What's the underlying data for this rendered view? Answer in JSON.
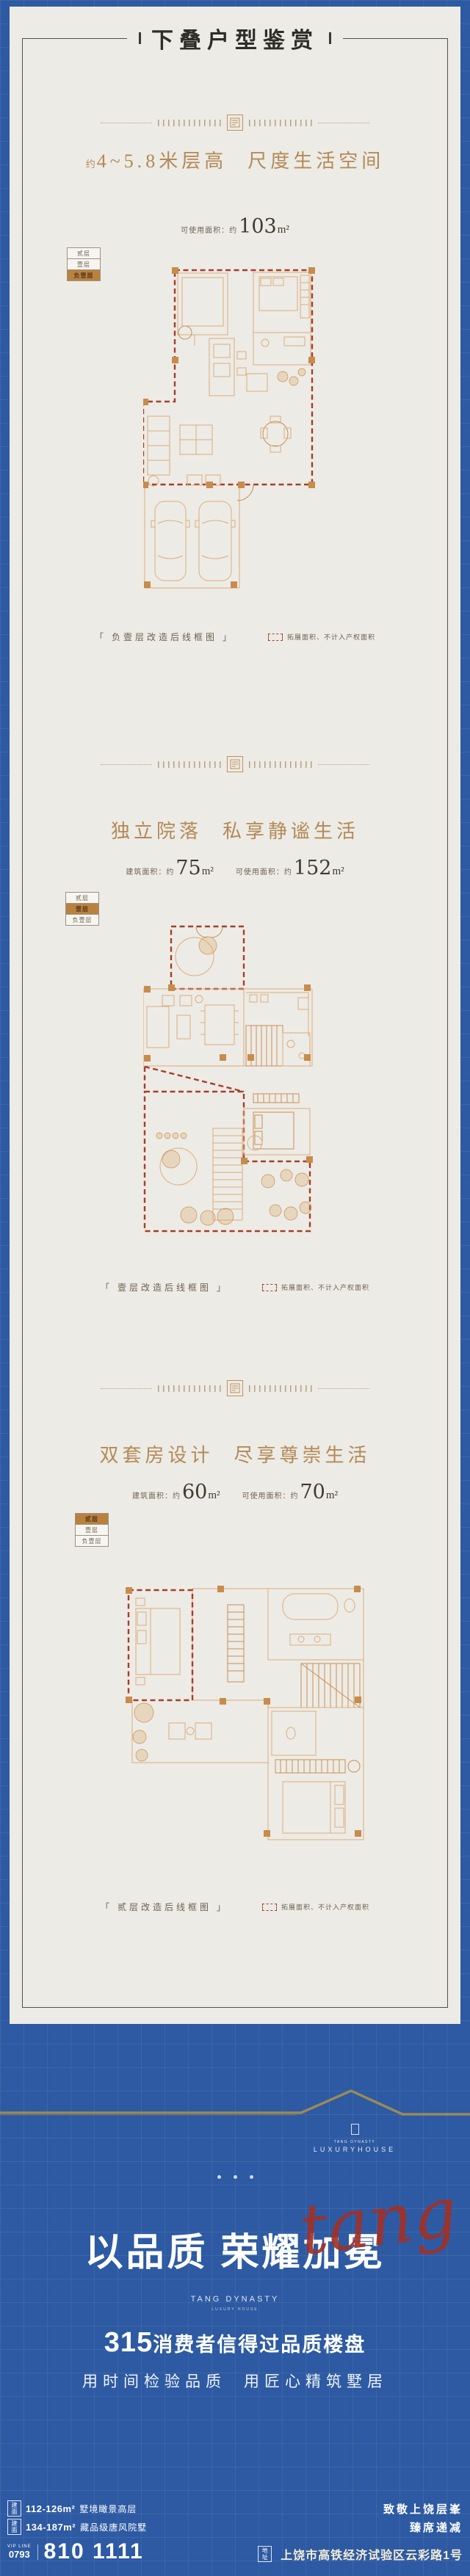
{
  "page_title": "下叠户型鉴赏",
  "legend_floors": [
    "贰层",
    "壹层",
    "负壹层"
  ],
  "plan_note": "拓展面积、不计入产权面积",
  "sections": [
    {
      "title_prefix": "约",
      "title_left": "4~5.8米层高",
      "title_right": "尺度生活空间",
      "metrics": [
        {
          "label": "可使用面积：约",
          "value": "103",
          "unit": "m²"
        }
      ],
      "active_floor": "负壹层",
      "caption": "「 负壹层改造后线框图 」"
    },
    {
      "title_prefix": "",
      "title_left": "独立院落",
      "title_right": "私享静谧生活",
      "metrics": [
        {
          "label": "建筑面积：约",
          "value": "75",
          "unit": "m²"
        },
        {
          "label": "可使用面积：约",
          "value": "152",
          "unit": "m²"
        }
      ],
      "active_floor": "壹层",
      "caption": "「 壹层改造后线框图 」"
    },
    {
      "title_prefix": "",
      "title_left": "双套房设计",
      "title_right": "尽享尊崇生活",
      "metrics": [
        {
          "label": "建筑面积：约",
          "value": "60",
          "unit": "m²"
        },
        {
          "label": "可使用面积：约",
          "value": "70",
          "unit": "m²"
        }
      ],
      "active_floor": "贰层",
      "caption": "「 贰层改造后线框图 」"
    }
  ],
  "hero": {
    "skyline_logo_small": "TANG DYNASTY",
    "skyline_logo": "LUXURYHOUSE",
    "headline": "以品质 荣耀加冕",
    "script": "tang",
    "brand_en": "TANG DYNASTY",
    "brand_sub": "LUXURY HOUSE",
    "claim_number": "315",
    "claim_text": "消费者信得过品质楼盘",
    "slogan_left": "用时间检验品质",
    "slogan_right": "用匠心精筑墅居"
  },
  "footer": {
    "lines": [
      {
        "tag": "建面",
        "spec": "112-126m²",
        "desc": "墅境瞰景高层",
        "slogan": "致敬上饶层峯"
      },
      {
        "tag": "建面",
        "spec": "134-187m²",
        "desc": "藏品级唐风院墅",
        "slogan": "臻席递减"
      }
    ],
    "phone_label": "VIP LINE",
    "phone_area": "0793",
    "phone_number": "810 1111",
    "address_tag": "地址",
    "address": "上饶市高铁经济试验区云彩路1号"
  },
  "colors": {
    "blue_background": "#2d5aa2",
    "card_cream": "#edebe5",
    "gold_title": "#b28a58",
    "red_dash": "#a63e2a",
    "column_brown": "#c78c4d"
  }
}
